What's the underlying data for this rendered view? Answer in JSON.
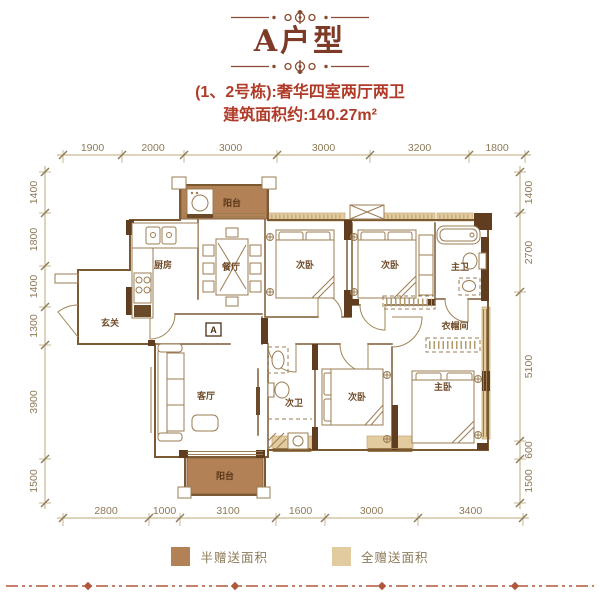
{
  "header": {
    "title": "A户型",
    "subtitle_line1": "(1、2号栋):奢华四室两厅两卫",
    "subtitle_line2": "建筑面积约:140.27m²"
  },
  "rooms": {
    "balcony_top": "阳台",
    "kitchen": "厨房",
    "dining": "餐厅",
    "entry": "玄关",
    "bedroom_top_1": "次卧",
    "bedroom_top_2": "次卧",
    "master_bath": "主卫",
    "closet": "衣帽间",
    "living": "客厅",
    "bath_2": "次卫",
    "bedroom_bottom": "次卧",
    "master_bedroom": "主卧",
    "balcony_bottom": "阳台",
    "unit_marker": "A"
  },
  "dimensions": {
    "top": [
      "1900",
      "2000",
      "3000",
      "3000",
      "3200",
      "1800"
    ],
    "bottom": [
      "2800",
      "1000",
      "3100",
      "1600",
      "3000",
      "3400"
    ],
    "left": [
      "1400",
      "1800",
      "1400",
      "1300",
      "3900",
      "1500"
    ],
    "right": [
      "1400",
      "2700",
      "5100",
      "600",
      "1500"
    ]
  },
  "legend": {
    "items": [
      {
        "label": "半赠送面积",
        "color": "#b28155"
      },
      {
        "label": "全赠送面积",
        "color": "#e2cb9f"
      }
    ]
  },
  "colors": {
    "title": "#7c3a27",
    "subtitle": "#b03b28",
    "wall": "#7b5a33",
    "structure": "#5f3d1e",
    "dimension": "#8d7a58",
    "footer_line": "#b2573a"
  }
}
